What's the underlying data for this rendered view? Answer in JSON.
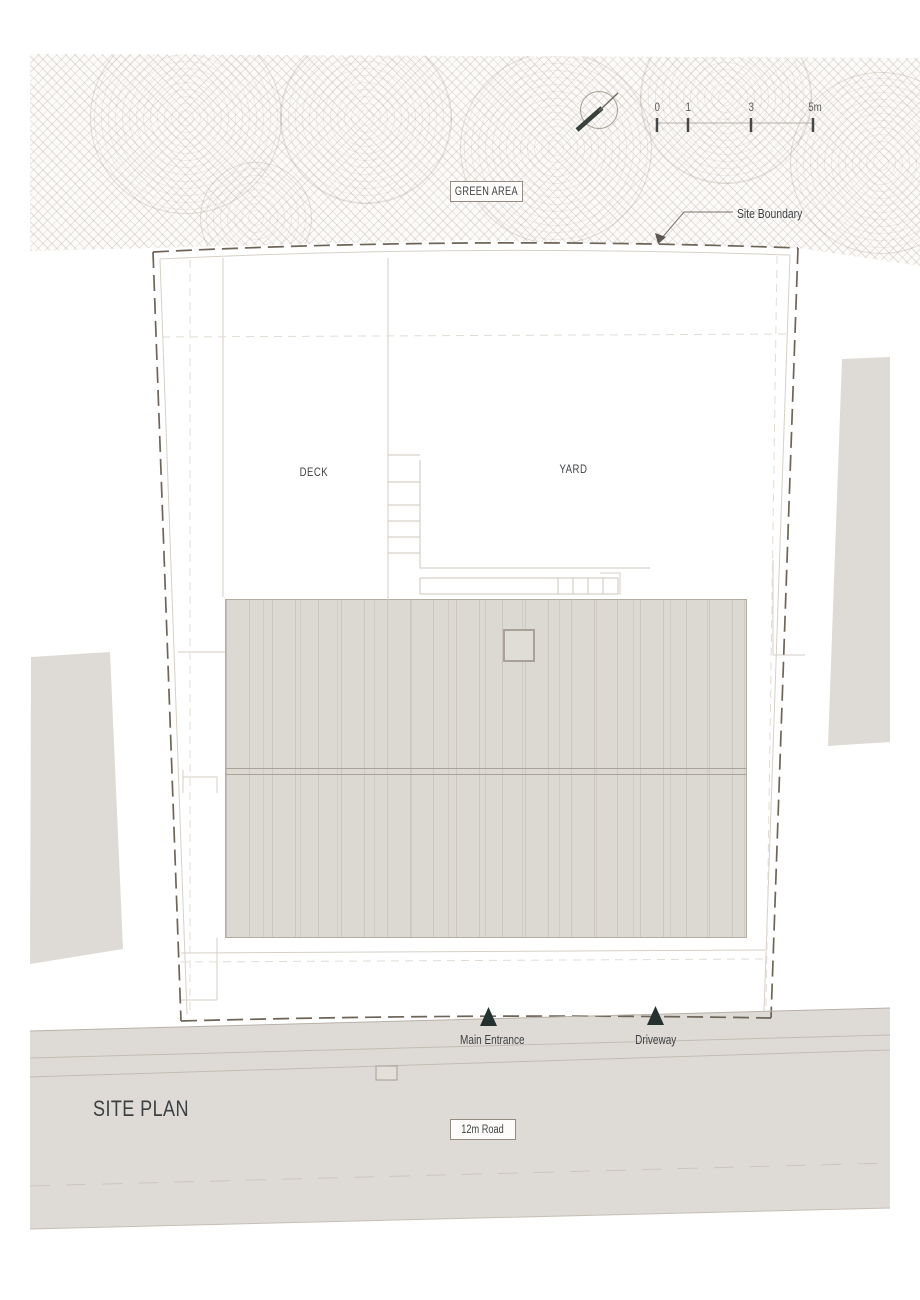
{
  "drawing": {
    "title": "SITE PLAN",
    "areas": {
      "green_area": "GREEN AREA",
      "deck": "DECK",
      "yard": "YARD",
      "road": "12m Road"
    },
    "annotations": {
      "site_boundary": "Site Boundary",
      "main_entrance": "Main Entrance",
      "driveway": "Driveway"
    },
    "scale_bar": {
      "ticks": [
        "0",
        "1",
        "3",
        "5m"
      ]
    },
    "icons": [
      "north-arrow-icon",
      "entrance-marker-icon",
      "driveway-marker-icon"
    ],
    "colors": {
      "surface_gray": "#dedbd6",
      "roof_gray": "#dcd8d2",
      "boundary_line": "#6e6458",
      "marker_dark": "#25312e",
      "text": "#3f4245",
      "hatch": "#a89c8f"
    }
  }
}
